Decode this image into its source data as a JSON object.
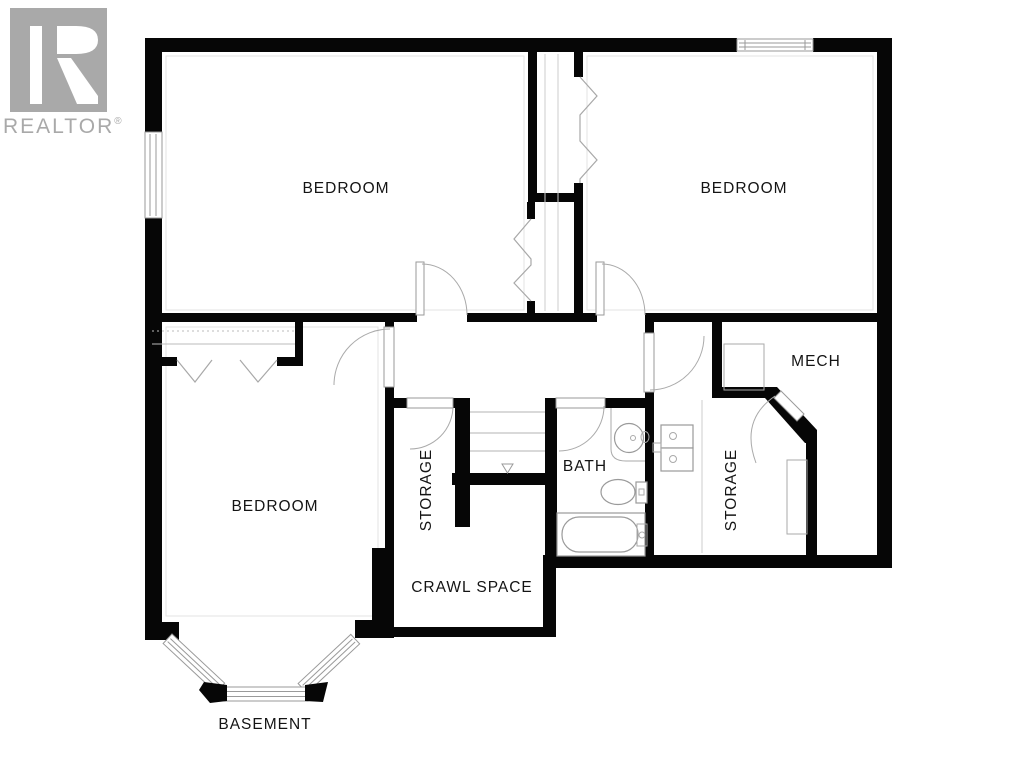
{
  "branding": {
    "logo_text": "REALTOR",
    "registered_mark": "®",
    "logo_color": "#a9a9a9"
  },
  "floor_label": "BASEMENT",
  "rooms": {
    "bedroom_top_left": {
      "label": "BEDROOM"
    },
    "bedroom_top_right": {
      "label": "BEDROOM"
    },
    "bedroom_lower_left": {
      "label": "BEDROOM"
    },
    "mech": {
      "label": "MECH"
    },
    "bath": {
      "label": "BATH"
    },
    "storage_left": {
      "label": "STORAGE"
    },
    "storage_right": {
      "label": "STORAGE"
    },
    "crawl_space": {
      "label": "CRAWL SPACE"
    }
  },
  "colors": {
    "wall": "#060606",
    "fixture_line": "#9a9a9a",
    "tread_line": "#c2c2c2",
    "label_text": "#141414",
    "background": "#ffffff"
  }
}
